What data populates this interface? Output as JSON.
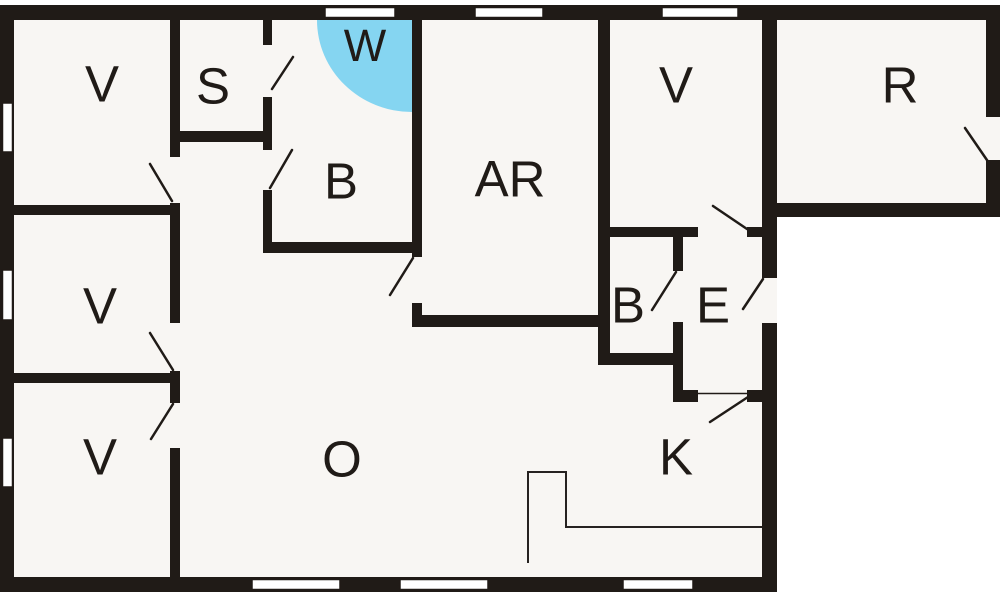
{
  "plan": {
    "type": "floor-plan",
    "colors": {
      "wall": "#201b17",
      "floor": "#f8f6f3",
      "background": "#ffffff",
      "shower_area": "#85d5f1",
      "window_fill": "#ffffff"
    },
    "rooms": [
      {
        "id": "bedroom-top-left",
        "label": "V"
      },
      {
        "id": "sauna",
        "label": "S"
      },
      {
        "id": "shower",
        "label": "W"
      },
      {
        "id": "bathroom",
        "label": "B"
      },
      {
        "id": "activity-room",
        "label": "AR"
      },
      {
        "id": "bedroom-mid-left",
        "label": "V"
      },
      {
        "id": "bedroom-bottom-left",
        "label": "V"
      },
      {
        "id": "bedroom-top-right",
        "label": "V"
      },
      {
        "id": "room-right",
        "label": "R"
      },
      {
        "id": "wc",
        "label": "B"
      },
      {
        "id": "entrance",
        "label": "E"
      },
      {
        "id": "living-room",
        "label": "O"
      },
      {
        "id": "kitchen",
        "label": "K"
      }
    ]
  }
}
